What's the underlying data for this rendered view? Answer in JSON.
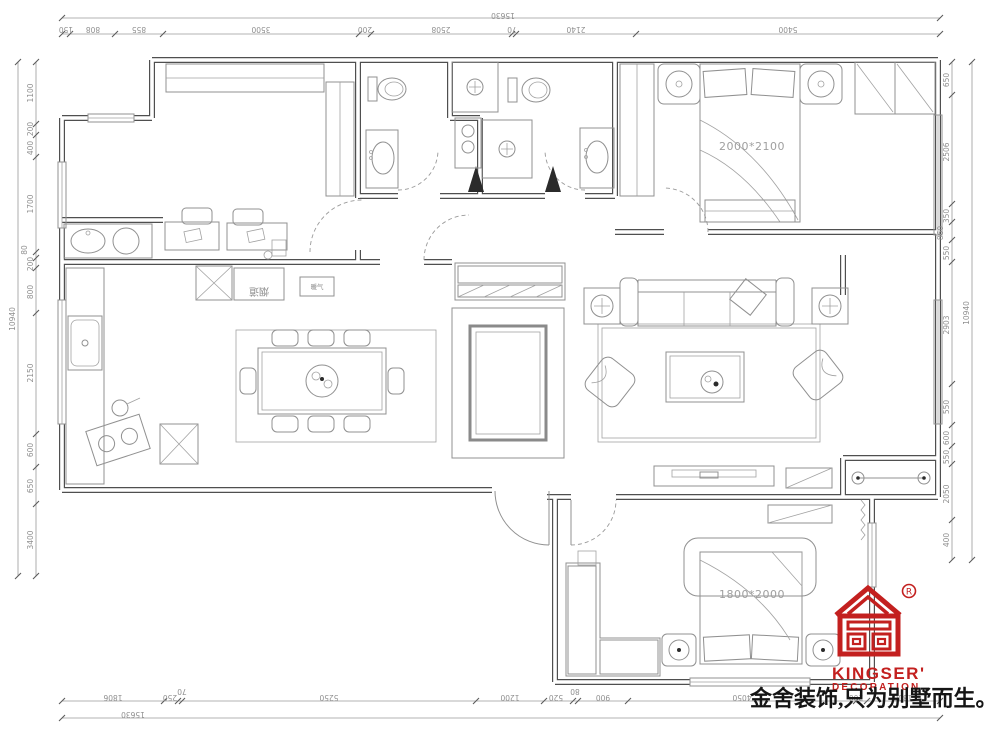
{
  "branding": {
    "name": "KINGSER'",
    "division": "DECORATION",
    "registered": "R",
    "slogan": "金舍装饰,只为别墅而生。",
    "color": "#c3201f"
  },
  "room_labels": {
    "master_bed_size": "2000*2100",
    "second_bed_size": "1800*2000",
    "flue": "烟道",
    "radiator": "暖气"
  },
  "dimensions": {
    "top": {
      "total": "15630",
      "segments": [
        "150",
        "808",
        "855",
        "3500",
        "200",
        "2508",
        "70",
        "2140",
        "5400"
      ]
    },
    "bottom": {
      "total": "15630",
      "segments": [
        "1806",
        "250",
        "70",
        "5250",
        "1200",
        "520",
        "80",
        "900",
        "4050",
        "200",
        "1300"
      ]
    },
    "left": {
      "total": "10940",
      "segments": [
        "1100",
        "200",
        "400",
        "1700",
        "80",
        "200",
        "800",
        "2150",
        "600",
        "650",
        "3400"
      ]
    },
    "right": {
      "total": "10940",
      "segments": [
        "650",
        "2506",
        "350",
        "860",
        "550",
        "2903",
        "550",
        "600",
        "550",
        "2050",
        "400"
      ]
    }
  }
}
